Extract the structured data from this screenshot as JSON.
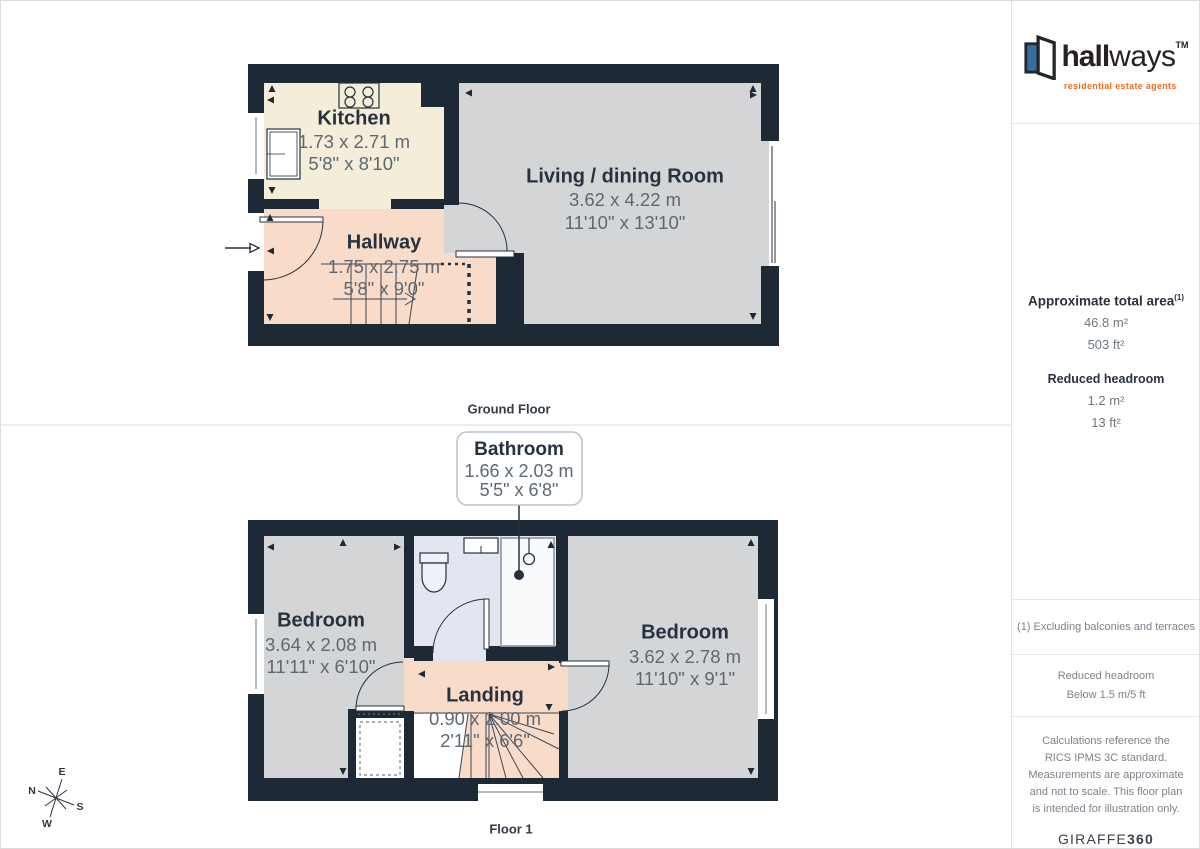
{
  "branding": {
    "brand_bold": "hall",
    "brand_light": "ways",
    "tm": "TM",
    "tagline": "residential estate agents",
    "accent_orange": "#f26b22",
    "accent_blue": "#3a6b9d"
  },
  "sidebar": {
    "total_area": {
      "label": "Approximate total area",
      "superscript": "(1)",
      "metric": "46.8 m²",
      "imperial": "503 ft²"
    },
    "reduced_headroom": {
      "label": "Reduced headroom",
      "metric": "1.2 m²",
      "imperial": "13 ft²"
    },
    "footnote": "(1) Excluding balconies and terraces",
    "legend": {
      "label": "Reduced headroom",
      "value": "Below 1.5 m/5 ft"
    },
    "disclaimer": "Calculations reference the RICS IPMS 3C standard. Measurements are approximate and not to scale. This floor plan is intended for illustration only.",
    "provider": "GIRAFFE",
    "provider_suffix": "360"
  },
  "floors": {
    "ground": {
      "label": "Ground Floor",
      "rooms": {
        "kitchen": {
          "name": "Kitchen",
          "metric": "1.73 x 2.71 m",
          "imperial": "5'8\" x 8'10\""
        },
        "living": {
          "name": "Living / dining Room",
          "metric": "3.62 x 4.22 m",
          "imperial": "11'10\" x 13'10\""
        },
        "hallway": {
          "name": "Hallway",
          "metric": "1.75 x 2.75 m",
          "imperial": "5'8\" x 9'0\""
        }
      }
    },
    "first": {
      "label": "Floor 1",
      "rooms": {
        "bathroom": {
          "name": "Bathroom",
          "metric": "1.66 x 2.03 m",
          "imperial": "5'5\" x 6'8\""
        },
        "bedroom_left": {
          "name": "Bedroom",
          "metric": "3.64 x 2.08 m",
          "imperial": "11'11\" x 6'10\""
        },
        "bedroom_right": {
          "name": "Bedroom",
          "metric": "3.62 x 2.78 m",
          "imperial": "11'10\" x 9'1\""
        },
        "landing": {
          "name": "Landing",
          "metric": "0.90 x 2.00 m",
          "imperial": "2'11\" x 6'6\""
        }
      }
    }
  },
  "compass": {
    "n": "N",
    "e": "E",
    "s": "S",
    "w": "W"
  },
  "colors": {
    "wall": "#1e2936",
    "kitchen_floor": "#f4edd9",
    "hall_floor": "#f8dcc9",
    "room_floor": "#d4d5d6",
    "bathroom_floor": "#e2e6f0"
  }
}
